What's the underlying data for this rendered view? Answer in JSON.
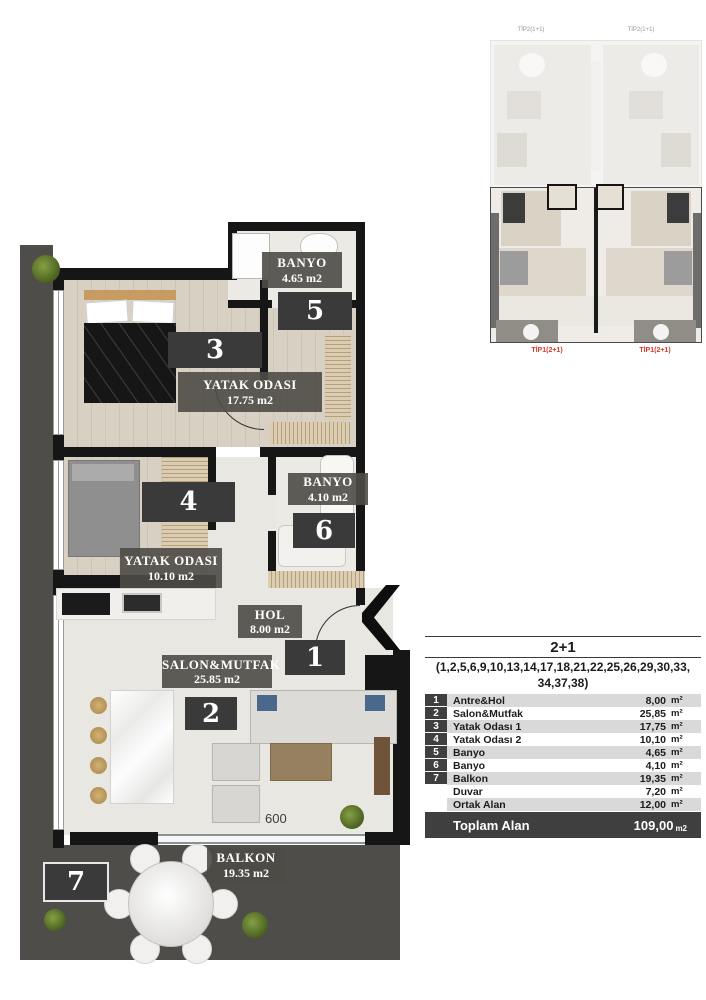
{
  "plan": {
    "labels": {
      "banyo5": {
        "name": "BANYO",
        "area": "4.65 m2"
      },
      "num5": "5",
      "bed3": {
        "name": "YATAK ODASI",
        "area": "17.75 m2"
      },
      "num3": "3",
      "bed4": {
        "name": "YATAK ODASI",
        "area": "10.10 m2"
      },
      "num4": "4",
      "banyo6": {
        "name": "BANYO",
        "area": "4.10 m2"
      },
      "num6": "6",
      "hol": {
        "name": "HOL",
        "area": "8.00 m2"
      },
      "num1": "1",
      "salon": {
        "name": "SALON&MUTFAK",
        "area": "25.85 m2"
      },
      "num2": "2",
      "balkon": {
        "name": "BALKON",
        "area": "19.35 m2"
      },
      "num7": "7",
      "dimension": "600"
    }
  },
  "minimap": {
    "tip2_left": "TİP2(1+1)",
    "tip2_right": "TİP2(1+1)",
    "tip1_left": "TİP1(2+1)",
    "tip1_right": "TİP1(2+1)"
  },
  "table": {
    "title": "2+1",
    "subtitle_line1": "(1,2,5,6,9,10,13,14,17,18,21,22,25,26,29,30,33,",
    "subtitle_line2": "34,37,38)",
    "rows": [
      {
        "num": "1",
        "name": "Antre&Hol",
        "value": "8,00",
        "unit": "m²"
      },
      {
        "num": "2",
        "name": "Salon&Mutfak",
        "value": "25,85",
        "unit": "m²"
      },
      {
        "num": "3",
        "name": "Yatak Odası 1",
        "value": "17,75",
        "unit": "m²"
      },
      {
        "num": "4",
        "name": "Yatak Odası 2",
        "value": "10,10",
        "unit": "m²"
      },
      {
        "num": "5",
        "name": "Banyo",
        "value": "4,65",
        "unit": "m²"
      },
      {
        "num": "6",
        "name": "Banyo",
        "value": "4,10",
        "unit": "m²"
      },
      {
        "num": "7",
        "name": "Balkon",
        "value": "19,35",
        "unit": "m²"
      },
      {
        "num": "",
        "name": "Duvar",
        "value": "7,20",
        "unit": "m²"
      },
      {
        "num": "",
        "name": "Ortak Alan",
        "value": "12,00",
        "unit": "m²"
      }
    ],
    "total": {
      "label": "Toplam Alan",
      "value": "109,00",
      "unit": "m2"
    }
  },
  "colors": {
    "wall": "#161616",
    "wood_floor": "#d6cec1",
    "marble_floor": "#e9e7e2",
    "terrace": "#4e4d4a",
    "label_box": "#4e4b46",
    "number_box": "#3a3a3a",
    "table_row_alt": "#d9d9d9",
    "table_dark": "#3f3f3f",
    "tip_red": "#d5392c"
  }
}
